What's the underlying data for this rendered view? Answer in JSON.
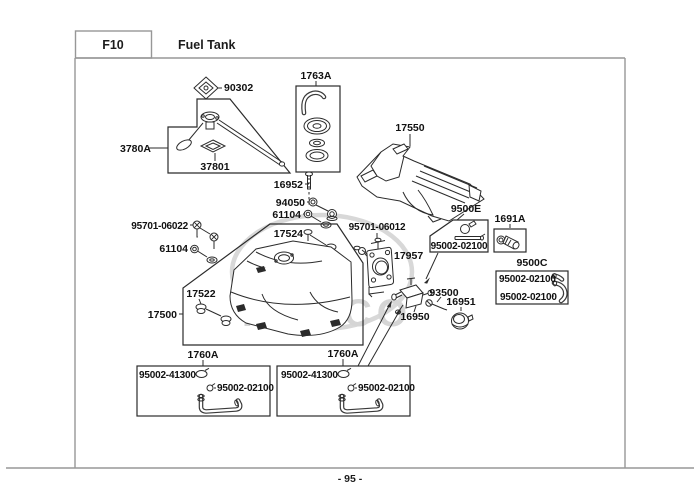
{
  "header": {
    "section_code": "F10",
    "section_title": "Fuel Tank"
  },
  "footer": {
    "page_number": "- 95 -"
  },
  "watermark": {
    "brand": "KYMCO",
    "color": "#d5d5d5"
  },
  "colors": {
    "line": "#2b2b2b",
    "frame": "#979797",
    "label": "#111111",
    "watermark": "#d5d5d5"
  },
  "labels": {
    "l90302": "90302",
    "l1763a": "1763A",
    "l17550": "17550",
    "l3780a": "3780A",
    "l37801": "37801",
    "l16952": "16952",
    "l94050": "94050",
    "l61104_top": "61104",
    "l17524": "17524",
    "l95701_06022": "95701-06022",
    "l61104_left": "61104",
    "l95701_06012": "95701-06012",
    "l17957": "17957",
    "l9500e": "9500E",
    "l9500e_sub": "95002-02100",
    "l1691a": "1691A",
    "l9500c": "9500C",
    "l9500c_row1": "95002-02100",
    "l9500c_row2": "95002-02100",
    "l17522": "17522",
    "l17500": "17500",
    "l93500": "93500",
    "l16951": "16951",
    "l16950": "16950",
    "l1760a_left": "1760A",
    "l1760a_right": "1760A",
    "box_left_row1": "95002-41300",
    "box_left_row2": "95002-02100",
    "box_right_row1": "95002-41300",
    "box_right_row2": "95002-02100"
  }
}
